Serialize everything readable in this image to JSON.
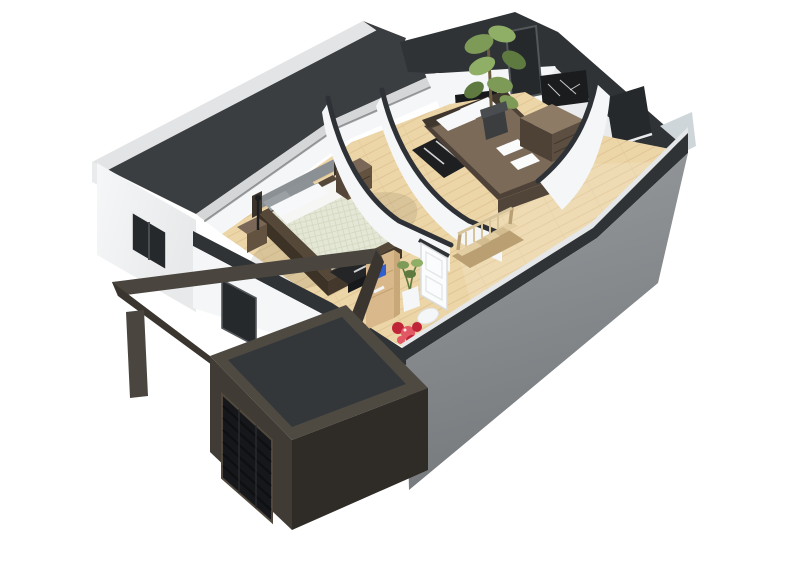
{
  "meta": {
    "title": "3D cutaway floor plan render - upper floor isometric dollhouse view",
    "style": "architectural 3D render on white background",
    "background": "#ffffff"
  },
  "colors": {
    "bg": "#ffffff",
    "parapetLight": "#e2e4e5",
    "parapetDim": "#d4d6d7",
    "roofDark": "#3a3e41",
    "bandDark": "#2f3336",
    "wallWhite": "#f5f6f7",
    "wallShaded": "#e9ebec",
    "wallBand": "#dcdfe0",
    "windowDark": "#26292c",
    "eastSliver": "#cfd6da",
    "grayWall": "#898d90",
    "grayWallDark": "#7b7f82",
    "slabLight": "#e5e7e8",
    "woodFloor": "#ecd5a7",
    "woodLine": "#d9bc8a",
    "bed1Duvet": "#e4e7d5",
    "bed1Sheet": "#f6f7f5",
    "frameBrown": "#564839",
    "frameBrownDark": "#44382c",
    "pillowWhite": "#f7f8f9",
    "pillowGray": "#9aa0a4",
    "headboardGray": "#8b9094",
    "nightstandTop": "#7a6757",
    "nightstandFront": "#63523f",
    "nightstandSide": "#55463a",
    "benchDark": "#232527",
    "bed2Brown": "#7b6a58",
    "bed2Frame": "#4e4238",
    "bed2Front": "#51453a",
    "headboard2": "#3f362d",
    "dresserTop": "#8d7b66",
    "dresserFront": "#5c4f42",
    "dresserSide": "#4e4236",
    "plantGreen": "#7d9b57",
    "plantGreenDark": "#5e7a40",
    "plantGreenLight": "#8fae66",
    "plantPot": "#3b3d3f",
    "trunkBrown": "#6b5b3f",
    "rugDark": "#1d1f21",
    "stairsWood": "#e2cea2",
    "stairsWoodAlt": "#d2bc90",
    "railWood": "#d8c49a",
    "railWoodDark": "#b89f74",
    "doorWhite": "#fbfcfd",
    "deskWood": "#d9b98c",
    "deskWoodTop": "#e6cf9e",
    "blueItem": "#2f5fd0",
    "redFlower": "#c02437",
    "redFlowerLight": "#e25864",
    "fixtureWhite": "#f4f6f7",
    "garageRim": "#4e4a42",
    "garageInset": "#33373a",
    "garageBody": "#403b34",
    "garageBodyDark": "#2f2b26",
    "garageDoor": "#15171a",
    "pergola": "#4a463f",
    "pergolaDark": "#3a362f"
  },
  "scene": {
    "exterior": {
      "left_wing": {
        "roof": "flat dark charcoal roof with light parapet rim",
        "wall": "white exterior wall",
        "windows": [
          "dark vertical window on upper-left wall",
          "dark window on lower front wall behind carport"
        ]
      },
      "front_right_wall": "gray concrete facade below the cutaway line",
      "back_walls": "white walls with dark charcoal cut tops, dark window recesses and framed wall art",
      "garage": {
        "door": "dark slatted sectional garage door",
        "roof": "flat dark inset roof with rim",
        "body": "dark brown-gray volume"
      },
      "carport": {
        "frame": "dark pergola beam frame",
        "post": "single square post"
      }
    },
    "interior": {
      "floor": "light oak plank flooring throughout",
      "cut_style": "partition walls sliced with sweeping concave curves, charcoal cut edges",
      "rooms": [
        {
          "name": "bedroom-left",
          "furniture": [
            "double bed with pale quilted duvet and dark wood frame",
            "gray upholstered headboard with white pillows",
            "two dark wood nightstands",
            "dark media bench with blue laptop"
          ]
        },
        {
          "name": "bedroom-right",
          "furniture": [
            "double bed with brown duvet",
            "white pillows and folded towels",
            "zebra-stripe rug",
            "dark chest of drawers",
            "tall potted ficus plant",
            "two dark wall windows",
            "speckled framed art"
          ]
        },
        {
          "name": "hallway",
          "furniture": [
            "staircase with oak treads",
            "oak balustrade railing",
            "open white panel door"
          ]
        },
        {
          "name": "study-corner",
          "furniture": [
            "light wood shelving desk",
            "blue accent object",
            "small potted plant in white pot",
            "white pouf seats",
            "red floor cushions"
          ]
        }
      ]
    }
  }
}
